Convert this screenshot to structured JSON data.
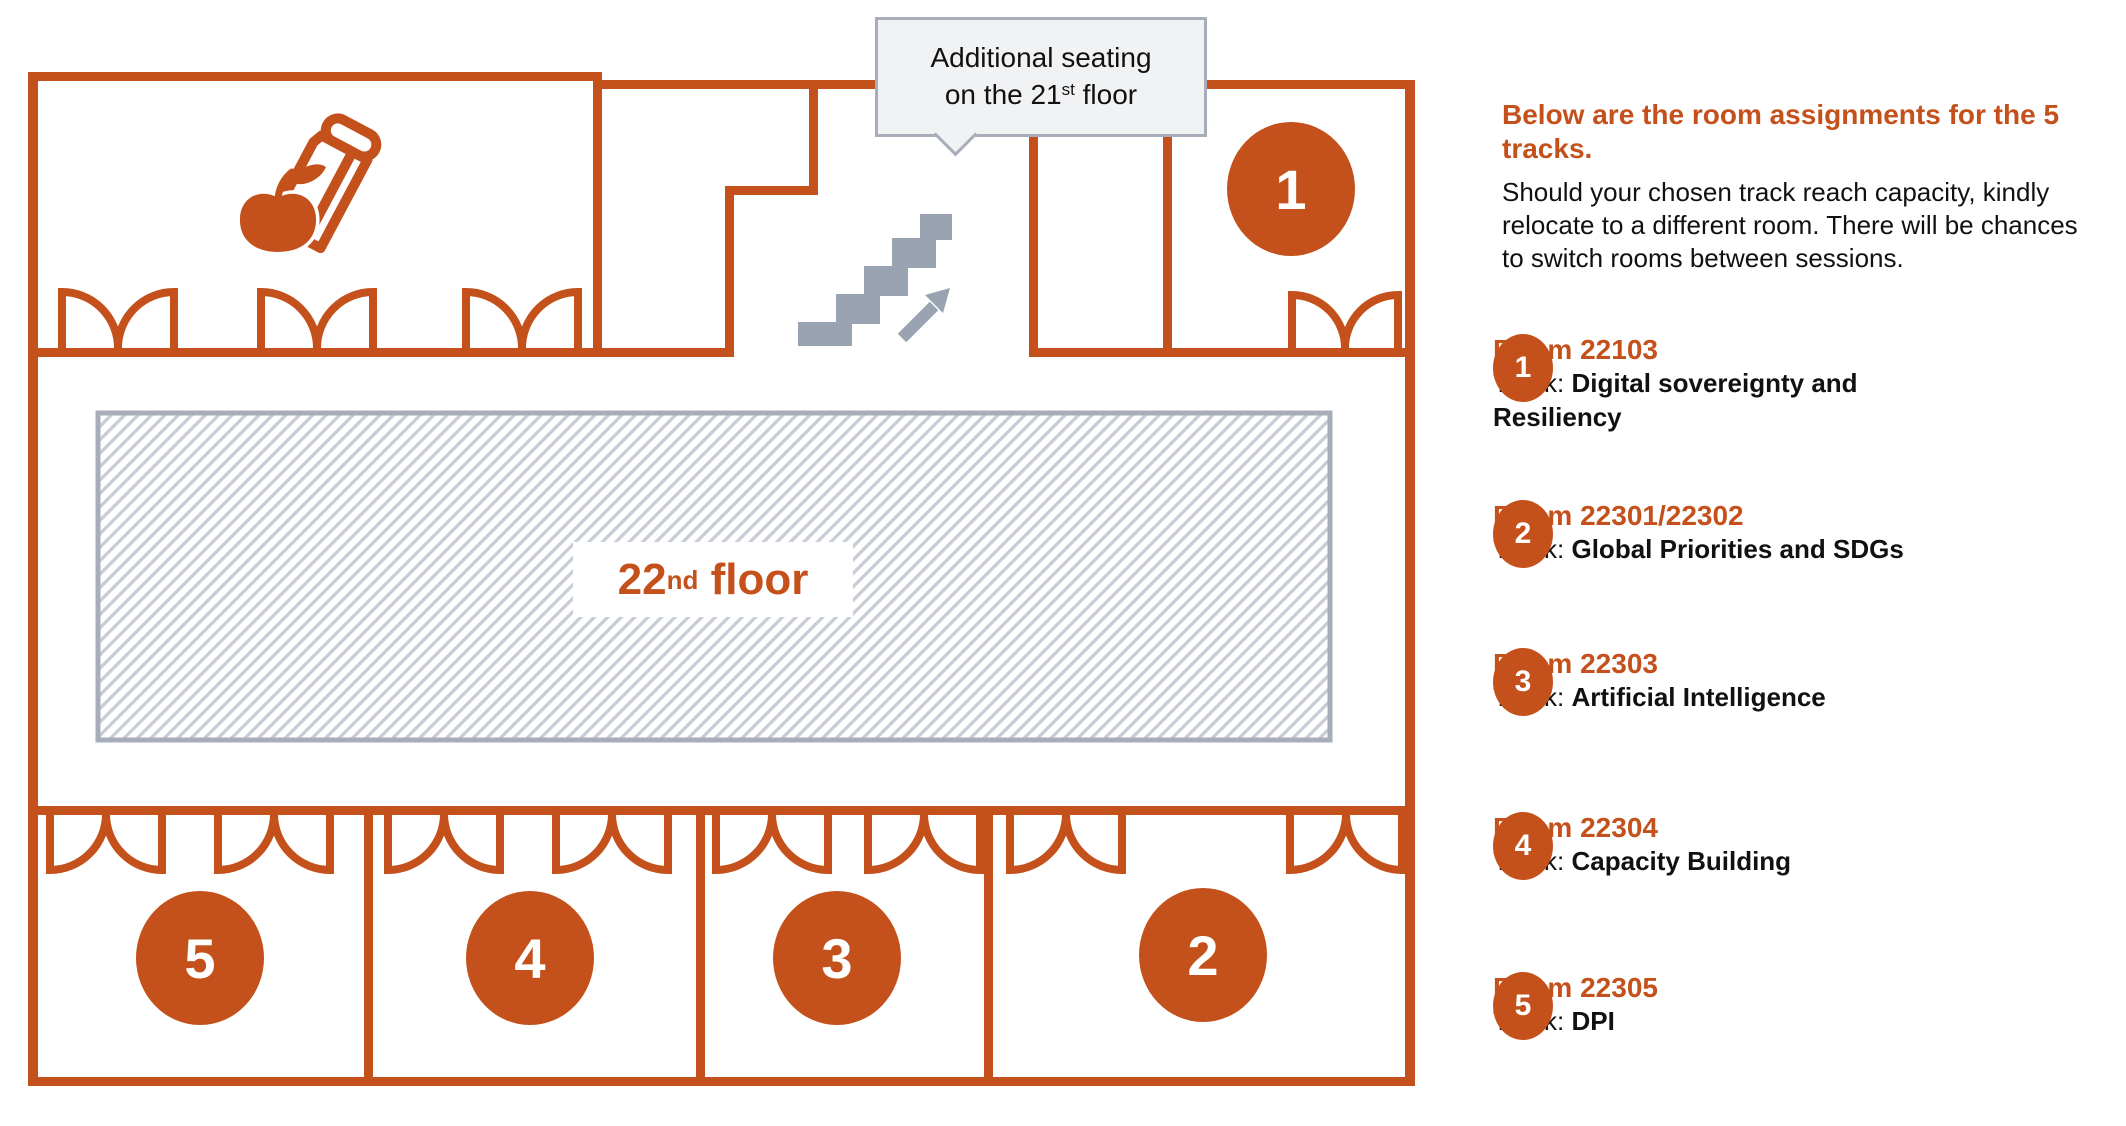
{
  "colors": {
    "orange": "#C4511B",
    "stairs_gray": "#9AA3B2",
    "border_gray": "#A7ADB9",
    "callout_bg": "#F1F2F4",
    "hatch_line": "#C8CDD5"
  },
  "callout": {
    "line1": "Additional seating",
    "line2_pre": "on the 21",
    "line2_sup": "st",
    "line2_post": " floor"
  },
  "floor_label": {
    "number": "22",
    "sup": "nd",
    "suffix": " floor"
  },
  "icons": {
    "lunch": "lunch-bag-and-apple-icon",
    "stairs": "stairs-up-icon"
  },
  "sidebar": {
    "heading": "Below are the room assignments for the 5 tracks.",
    "body": "Should your chosen track reach capacity, kindly relocate to a different room. There will be chances to switch rooms between sessions.",
    "track_prefix": "Track: ",
    "items": [
      {
        "number": "1",
        "room": "Room 22103",
        "track": "Digital sovereignty and Resiliency"
      },
      {
        "number": "2",
        "room": "Room 22301/22302",
        "track": "Global Priorities and SDGs"
      },
      {
        "number": "3",
        "room": "Room 22303",
        "track": "Artificial Intelligence"
      },
      {
        "number": "4",
        "room": "Room 22304",
        "track": "Capacity Building"
      },
      {
        "number": "5",
        "room": "Room 22305",
        "track": "DPI"
      }
    ]
  }
}
